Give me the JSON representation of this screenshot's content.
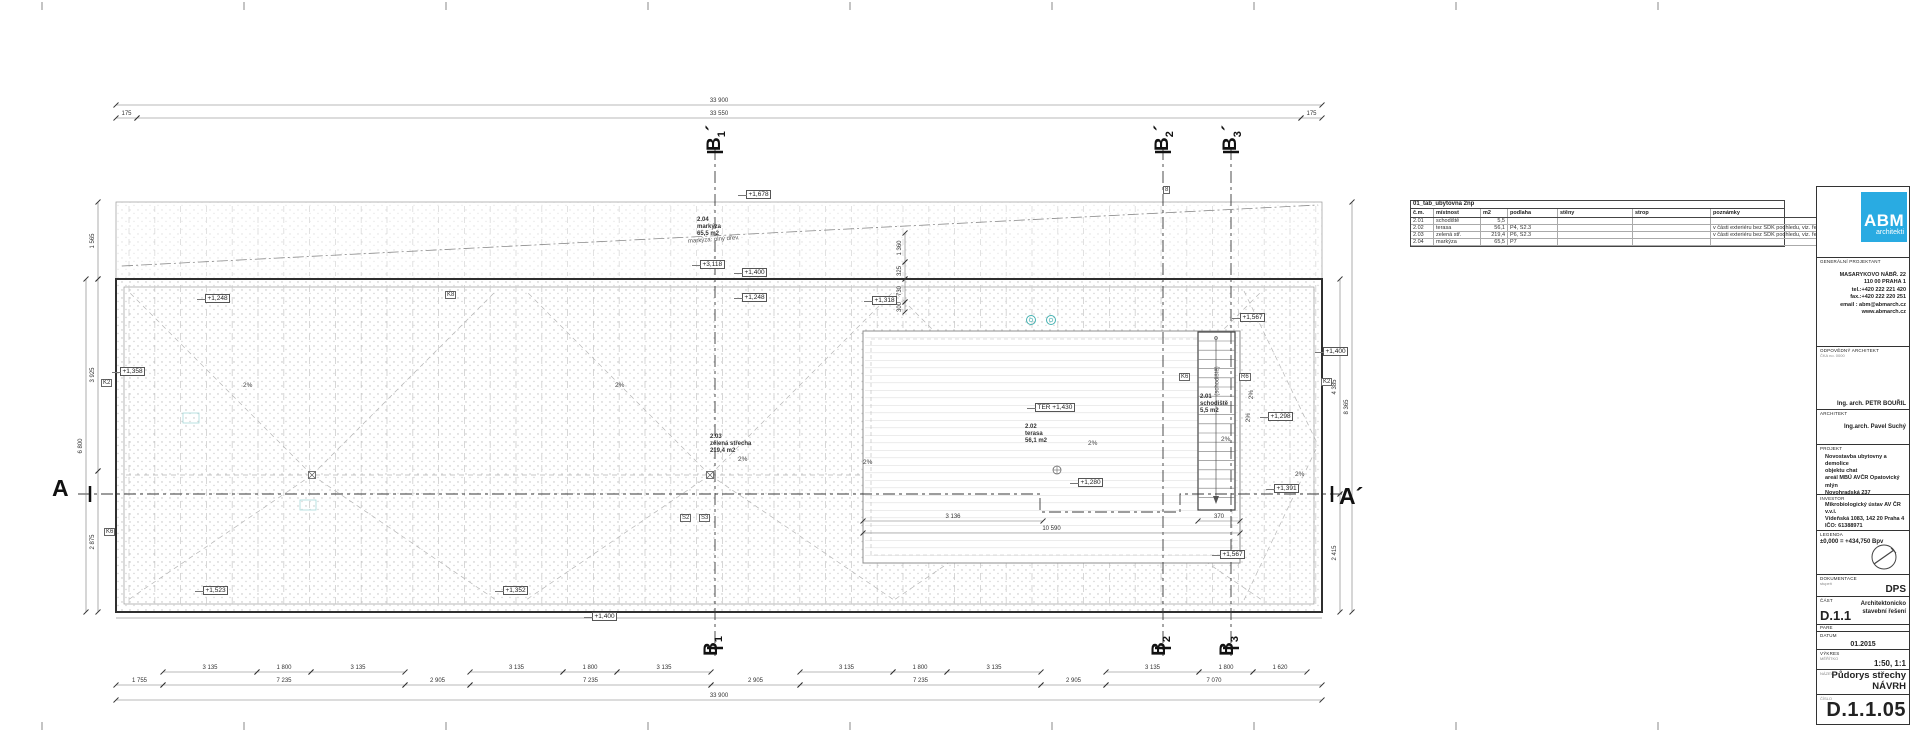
{
  "title_block": {
    "logo_main": "ABM",
    "logo_sub": "architekti",
    "logo_color": "#29abe2",
    "general_designer_label": "GENERÁLNÍ PROJEKTANT",
    "address_lines": [
      "MASARYKOVO NÁBŘ. 22",
      "110 00 PRAHA 1",
      "tel.:+420 222 221 420",
      "fax.:+420 222 220 251",
      "email : abm@abmarch.cz",
      "www.abmarch.cz"
    ],
    "responsible_architect_label": "ODPOVĚDNÝ ARCHITEKT",
    "responsible_architect_note": "ČKA no. 0000",
    "responsible_architect": "Ing. arch. PETR BOUŘIL",
    "architect_label": "ARCHITEKT",
    "architect": "Ing.arch. Pavel Suchý",
    "project_label": "PROJEKT",
    "project_lines": [
      "Novostavba ubytovny a demolice",
      "objektu chat",
      "areál MBÚ AVČR Opatovický mlýn",
      "Novohradská 237",
      "379 81 Třeboň"
    ],
    "investor_label": "INVESTOR",
    "investor_lines": [
      "Mikrobiologický ústav AV ČR v.v.i.",
      "Vídeňská 1083, 142 20 Praha 4",
      "IČO: 61388971"
    ],
    "legend_label": "LEGENDA",
    "datum_line": "±0,000 = +434,750 Bpv",
    "documentation_label": "DOKUMENTACE",
    "documentation_note": "stupeň",
    "documentation": "DPS",
    "part_label": "ČÁST",
    "part_code": "D.1.1",
    "part_name_line1": "Architektonicko",
    "part_name_line2": "stavební řešení",
    "pare_label": "PARE",
    "date_label": "DATUM",
    "date": "01.2015",
    "drawing_label": "VÝKRES",
    "scale_label": "MĚŘÍTKO",
    "scale": "1:50, 1:1",
    "name_label": "NÁZEV",
    "drawing_name_line1": "Půdorys střechy",
    "drawing_name_line2": "NÁVRH",
    "number_label": "ČÍSLO",
    "number": "D.1.1.05"
  },
  "room_table": {
    "title": "01_tab_ubytovna 2np",
    "headers": [
      "č.m.",
      "místnost",
      "m2",
      "podlaha",
      "stěny",
      "strop",
      "poznámky"
    ],
    "col_widths": [
      18,
      42,
      22,
      45,
      70,
      73,
      105
    ],
    "rows": [
      [
        "2.01",
        "schodiště",
        "5,5",
        "",
        "",
        "",
        ""
      ],
      [
        "2.02",
        "terasa",
        "56,1",
        "P4, S2.3",
        "",
        "",
        "v části exteriéru bez SDK podhledu, viz. řezy"
      ],
      [
        "2.03",
        "zelená stř.",
        "219,4",
        "P6, S2.3",
        "",
        "",
        "v části exteriéru bez SDK podhledu, viz. řezy"
      ],
      [
        "2.04",
        "markýza",
        "65,5",
        "P7",
        "",
        "",
        ""
      ]
    ]
  },
  "plan": {
    "slope_label": "2%",
    "levels": [
      {
        "x": 746,
        "y": 190,
        "t": "+1,678"
      },
      {
        "x": 700,
        "y": 260,
        "t": "+3,118"
      },
      {
        "x": 742,
        "y": 268,
        "t": "+1,400"
      },
      {
        "x": 742,
        "y": 293,
        "t": "+1,248"
      },
      {
        "x": 205,
        "y": 294,
        "t": "+1,248"
      },
      {
        "x": 120,
        "y": 367,
        "t": "+1,358"
      },
      {
        "x": 872,
        "y": 296,
        "t": "+1,318"
      },
      {
        "x": 1240,
        "y": 313,
        "t": "+1,567"
      },
      {
        "x": 1323,
        "y": 347,
        "t": "+1,400"
      },
      {
        "x": 1268,
        "y": 412,
        "t": "+1,298"
      },
      {
        "x": 1274,
        "y": 484,
        "t": "+1,391"
      },
      {
        "x": 1220,
        "y": 550,
        "t": "+1,567"
      },
      {
        "x": 1035,
        "y": 403,
        "t": "TER +1,430"
      },
      {
        "x": 1078,
        "y": 478,
        "t": "+1,280"
      },
      {
        "x": 203,
        "y": 586,
        "t": "+1,523"
      },
      {
        "x": 503,
        "y": 586,
        "t": "+1,352"
      },
      {
        "x": 592,
        "y": 612,
        "t": "+1,400"
      }
    ],
    "rooms": [
      {
        "x": 697,
        "y": 217,
        "lines": [
          "2.04",
          "markýza",
          "65,5 m2"
        ]
      },
      {
        "x": 710,
        "y": 434,
        "lines": [
          "2.03",
          "zelená střecha",
          "219,4 m2"
        ]
      },
      {
        "x": 1025,
        "y": 424,
        "lines": [
          "2.02",
          "terasa",
          "56,1 m2"
        ]
      },
      {
        "x": 1200,
        "y": 394,
        "lines": [
          "2.01",
          "schodiště",
          "5,5 m2"
        ]
      }
    ],
    "notes": [
      {
        "x": 688,
        "y": 237,
        "rot": -4,
        "t": "markýza: plný dřev."
      },
      {
        "x": 1203,
        "y": 378,
        "rot": -90,
        "t": "(schodiště)"
      }
    ],
    "slopes": [
      {
        "x": 243,
        "y": 382,
        "rot": 0
      },
      {
        "x": 615,
        "y": 382,
        "rot": 0
      },
      {
        "x": 738,
        "y": 456,
        "rot": 0
      },
      {
        "x": 863,
        "y": 459,
        "rot": 0
      },
      {
        "x": 1088,
        "y": 440,
        "rot": 0
      },
      {
        "x": 1221,
        "y": 436,
        "rot": 0
      },
      {
        "x": 1295,
        "y": 471,
        "rot": 0
      },
      {
        "x": 1247,
        "y": 391,
        "rot": -90
      },
      {
        "x": 1244,
        "y": 414,
        "rot": -90
      }
    ],
    "markers": [
      {
        "x": 101,
        "y": 379,
        "t": "K2"
      },
      {
        "x": 1321,
        "y": 378,
        "t": "K2"
      },
      {
        "x": 1239,
        "y": 373,
        "t": "R6"
      },
      {
        "x": 1179,
        "y": 373,
        "t": "K6"
      },
      {
        "x": 445,
        "y": 291,
        "t": "K8"
      },
      {
        "x": 104,
        "y": 528,
        "t": "K6"
      },
      {
        "x": 680,
        "y": 514,
        "t": "S2"
      },
      {
        "x": 699,
        "y": 514,
        "t": "S3"
      },
      {
        "x": 1163,
        "y": 186,
        "t": "8"
      }
    ],
    "dims_h": [
      {
        "y": 105,
        "x1": 116,
        "x2": 1322,
        "l": "33 900"
      },
      {
        "y": 118,
        "x1": 116,
        "x2": 137,
        "l": "175"
      },
      {
        "y": 118,
        "x1": 137,
        "x2": 1301,
        "l": "33 550"
      },
      {
        "y": 118,
        "x1": 1301,
        "x2": 1322,
        "l": "175"
      },
      {
        "y": 672,
        "x1": 163,
        "x2": 257,
        "l": "3 135"
      },
      {
        "y": 672,
        "x1": 257,
        "x2": 311,
        "l": "1 800"
      },
      {
        "y": 672,
        "x1": 311,
        "x2": 405,
        "l": "3 135"
      },
      {
        "y": 672,
        "x1": 470,
        "x2": 563,
        "l": "3 135"
      },
      {
        "y": 672,
        "x1": 563,
        "x2": 617,
        "l": "1 800"
      },
      {
        "y": 672,
        "x1": 617,
        "x2": 711,
        "l": "3 135"
      },
      {
        "y": 672,
        "x1": 800,
        "x2": 893,
        "l": "3 135"
      },
      {
        "y": 672,
        "x1": 893,
        "x2": 947,
        "l": "1 800"
      },
      {
        "y": 672,
        "x1": 947,
        "x2": 1041,
        "l": "3 135"
      },
      {
        "y": 672,
        "x1": 1106,
        "x2": 1199,
        "l": "3 135"
      },
      {
        "y": 672,
        "x1": 1199,
        "x2": 1253,
        "l": "1 800"
      },
      {
        "y": 672,
        "x1": 1253,
        "x2": 1307,
        "l": "1 620"
      },
      {
        "y": 685,
        "x1": 116,
        "x2": 163,
        "l": "1 755"
      },
      {
        "y": 685,
        "x1": 163,
        "x2": 405,
        "l": "7 235"
      },
      {
        "y": 685,
        "x1": 405,
        "x2": 470,
        "l": "2 905"
      },
      {
        "y": 685,
        "x1": 470,
        "x2": 711,
        "l": "7 235"
      },
      {
        "y": 685,
        "x1": 711,
        "x2": 800,
        "l": "2 905"
      },
      {
        "y": 685,
        "x1": 800,
        "x2": 1041,
        "l": "7 235"
      },
      {
        "y": 685,
        "x1": 1041,
        "x2": 1106,
        "l": "2 905"
      },
      {
        "y": 685,
        "x1": 1106,
        "x2": 1322,
        "l": "7 070"
      },
      {
        "y": 700,
        "x1": 116,
        "x2": 1322,
        "l": "33 900"
      },
      {
        "y": 521,
        "x1": 863,
        "x2": 1043,
        "l": "3 136"
      },
      {
        "y": 521,
        "x1": 1198,
        "x2": 1240,
        "l": "370"
      },
      {
        "y": 533,
        "x1": 863,
        "x2": 1240,
        "l": "10 590"
      }
    ],
    "dims_v": [
      {
        "x": 98,
        "y1": 202,
        "y2": 279,
        "l": "1 565"
      },
      {
        "x": 98,
        "y1": 279,
        "y2": 471,
        "l": "3 925"
      },
      {
        "x": 98,
        "y1": 471,
        "y2": 612,
        "l": "2 875"
      },
      {
        "x": 86,
        "y1": 279,
        "y2": 612,
        "l": "6 800"
      },
      {
        "x": 1340,
        "y1": 279,
        "y2": 494,
        "l": "4 385"
      },
      {
        "x": 1340,
        "y1": 494,
        "y2": 612,
        "l": "2 415"
      },
      {
        "x": 1352,
        "y1": 202,
        "y2": 612,
        "l": "8 365"
      },
      {
        "x": 905,
        "y1": 233,
        "y2": 262,
        "l": "1 360"
      },
      {
        "x": 905,
        "y1": 262,
        "y2": 279,
        "l": "325"
      },
      {
        "x": 905,
        "y1": 279,
        "y2": 302,
        "l": "730"
      },
      {
        "x": 905,
        "y1": 302,
        "y2": 312,
        "l": "300"
      }
    ],
    "sections": {
      "top_y": 126,
      "bottom_y": 634,
      "top": [
        {
          "x": 715,
          "main": "B",
          "sub": "1",
          "prime": "´"
        },
        {
          "x": 1163,
          "main": "B",
          "sub": "2",
          "prime": "´"
        },
        {
          "x": 1231,
          "main": "B",
          "sub": "3",
          "prime": "´"
        }
      ],
      "bottom": [
        {
          "x": 715,
          "main": "B",
          "sub": "1",
          "prime": ""
        },
        {
          "x": 1163,
          "main": "B",
          "sub": "2",
          "prime": ""
        },
        {
          "x": 1231,
          "main": "B",
          "sub": "3",
          "prime": ""
        }
      ],
      "left": {
        "x": 52,
        "y": 475,
        "t": "A"
      },
      "right": {
        "x": 1339,
        "y": 483,
        "t": "A´"
      }
    }
  }
}
